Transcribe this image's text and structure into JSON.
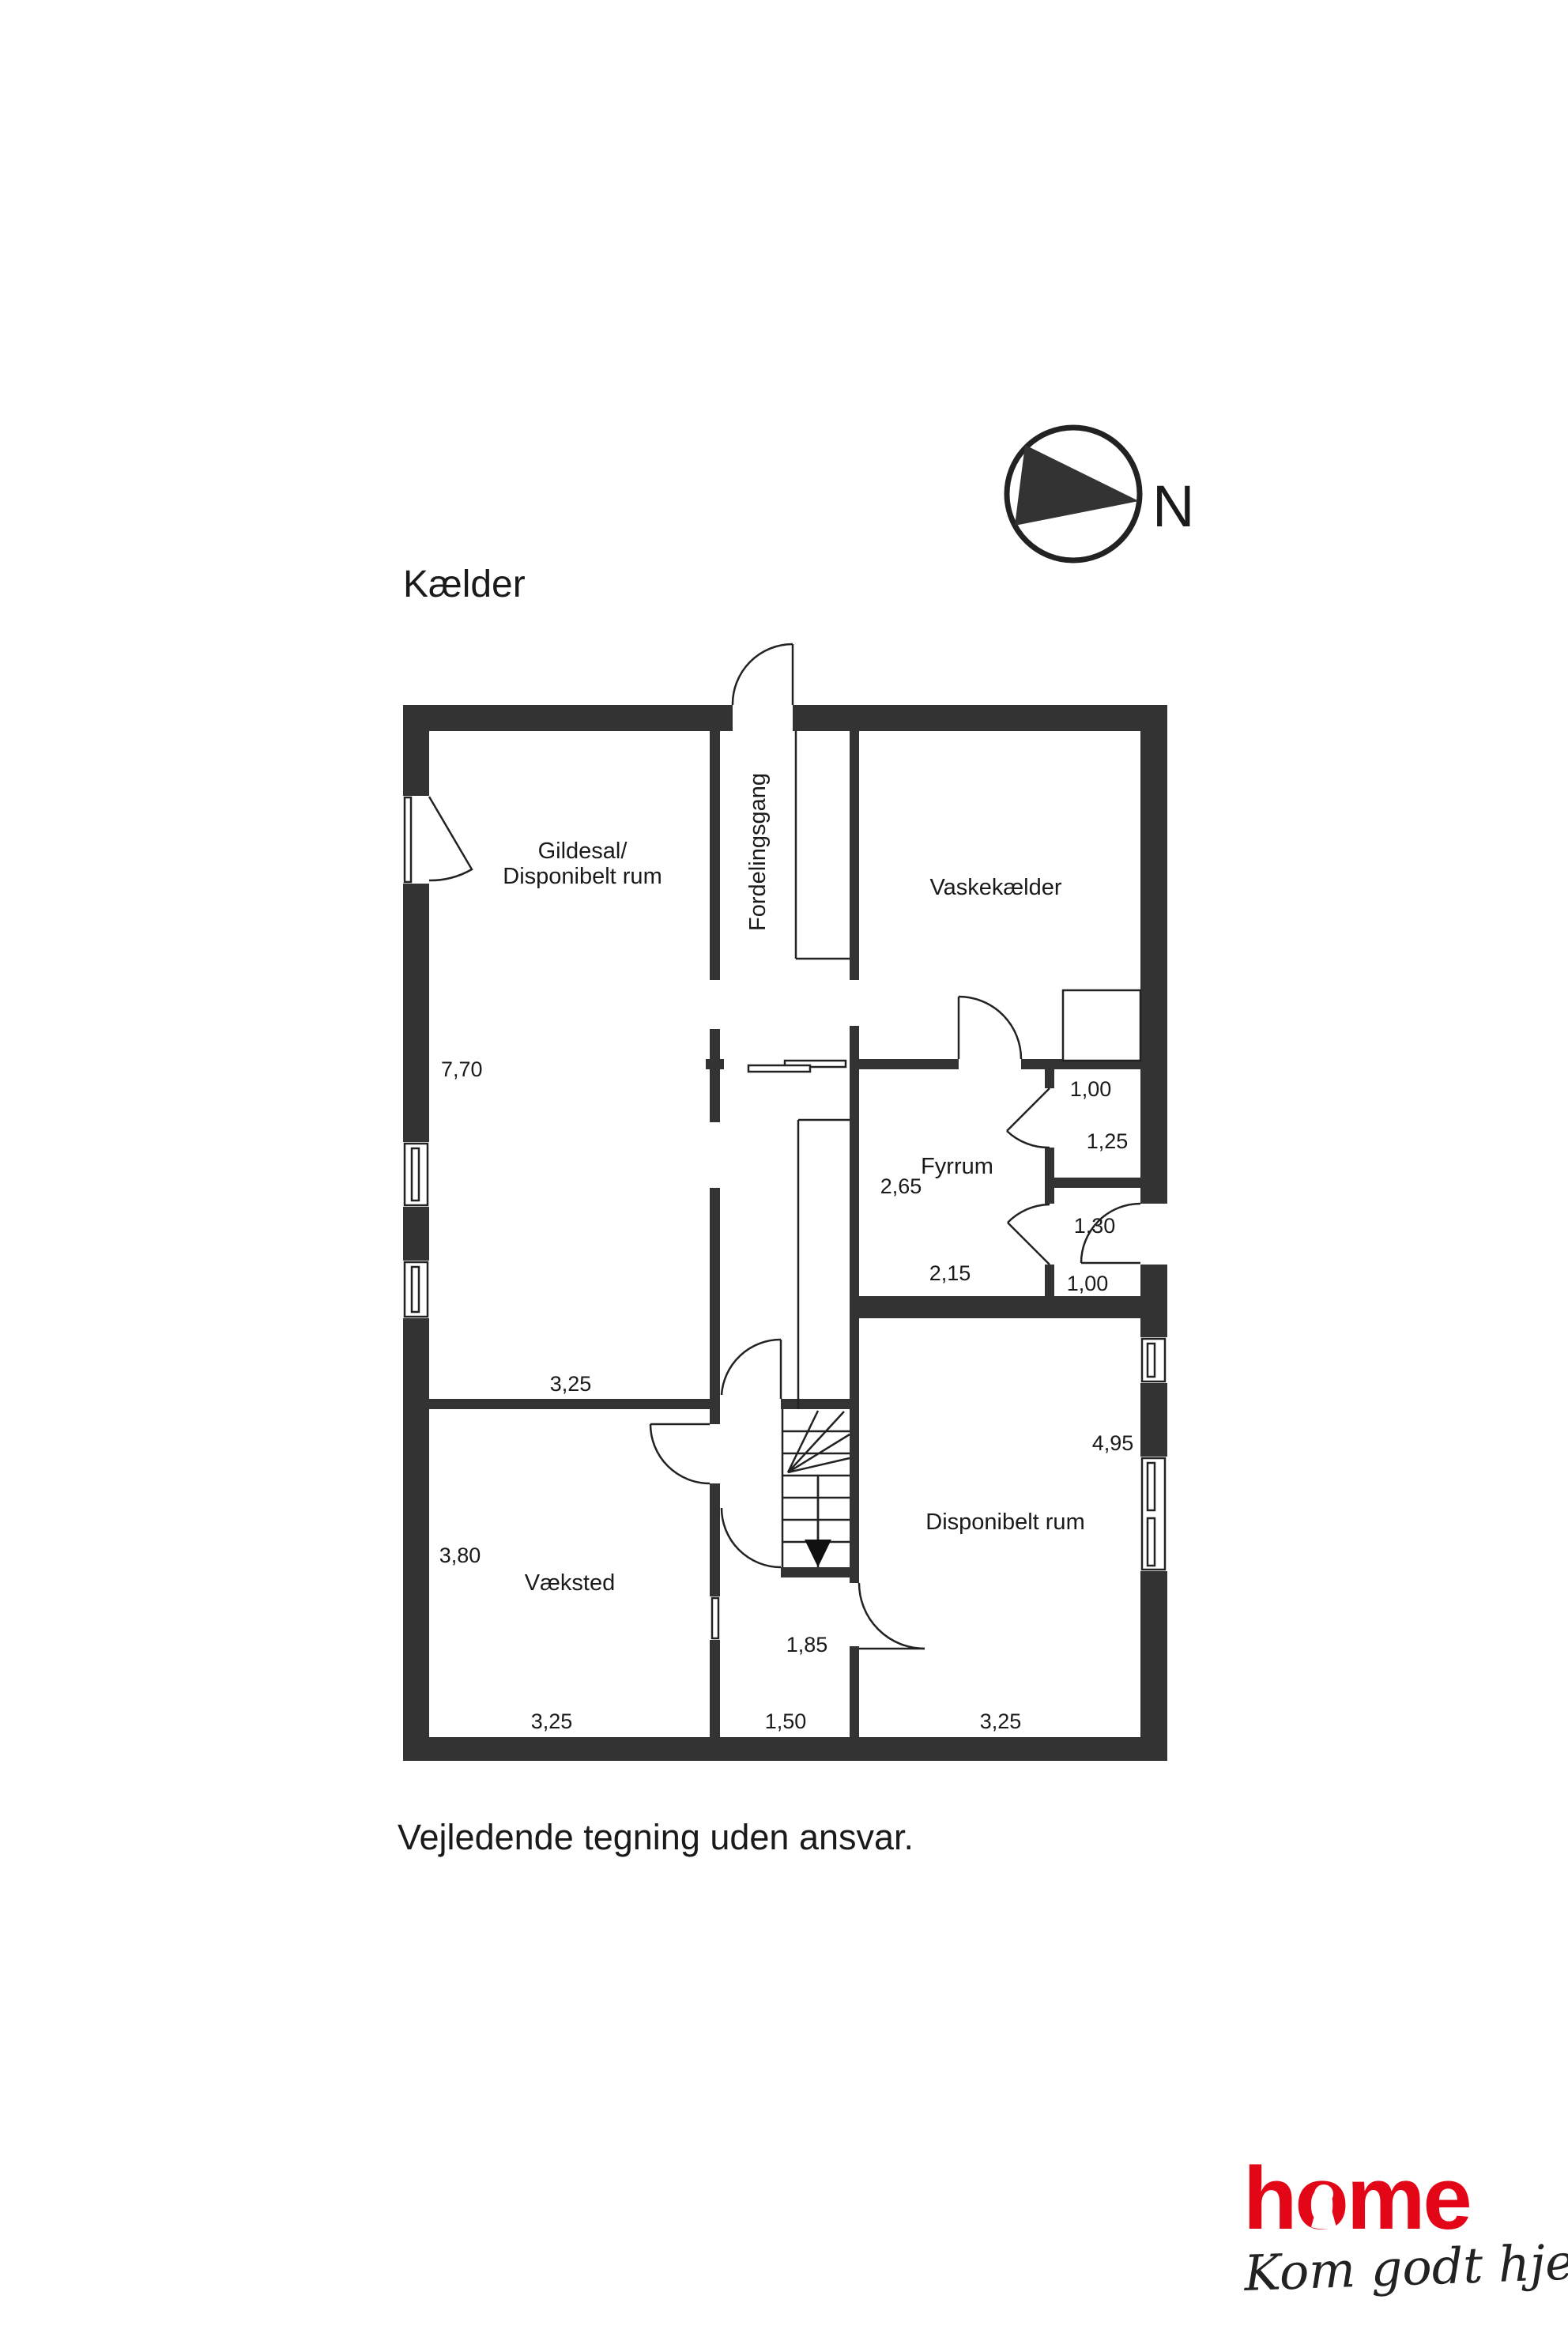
{
  "title": "Kælder",
  "footer": "Vejledende tegning uden ansvar.",
  "north": {
    "label": "N"
  },
  "rooms": {
    "gildesal1": "Gildesal/",
    "gildesal2": "Disponibelt rum",
    "fordelingsgang": "Fordelingsgang",
    "vaskekaelder": "Vaskekælder",
    "fyrrum": "Fyrrum",
    "vaeksted": "Væksted",
    "disponibelt": "Disponibelt rum"
  },
  "dims": {
    "gildesal_h": "7,70",
    "gildesal_w": "3,25",
    "vaeksted_h": "3,80",
    "vaeksted_w": "3,25",
    "hall_w": "1,50",
    "disponibelt_w": "3,25",
    "disponibelt_h": "4,95",
    "stairhall_w": "1,85",
    "fyrrum_h": "2,65",
    "fyrrum_w": "2,15",
    "closet1_w": "1,00",
    "closet1_h": "1,25",
    "closet2_w": "1,30",
    "closet2_h": "1,00"
  },
  "logo": {
    "brand": "home",
    "tagline": "Kom godt hjem"
  },
  "colors": {
    "wall": "#333333",
    "brand_red": "#e30617",
    "text": "#1a1a1a"
  }
}
